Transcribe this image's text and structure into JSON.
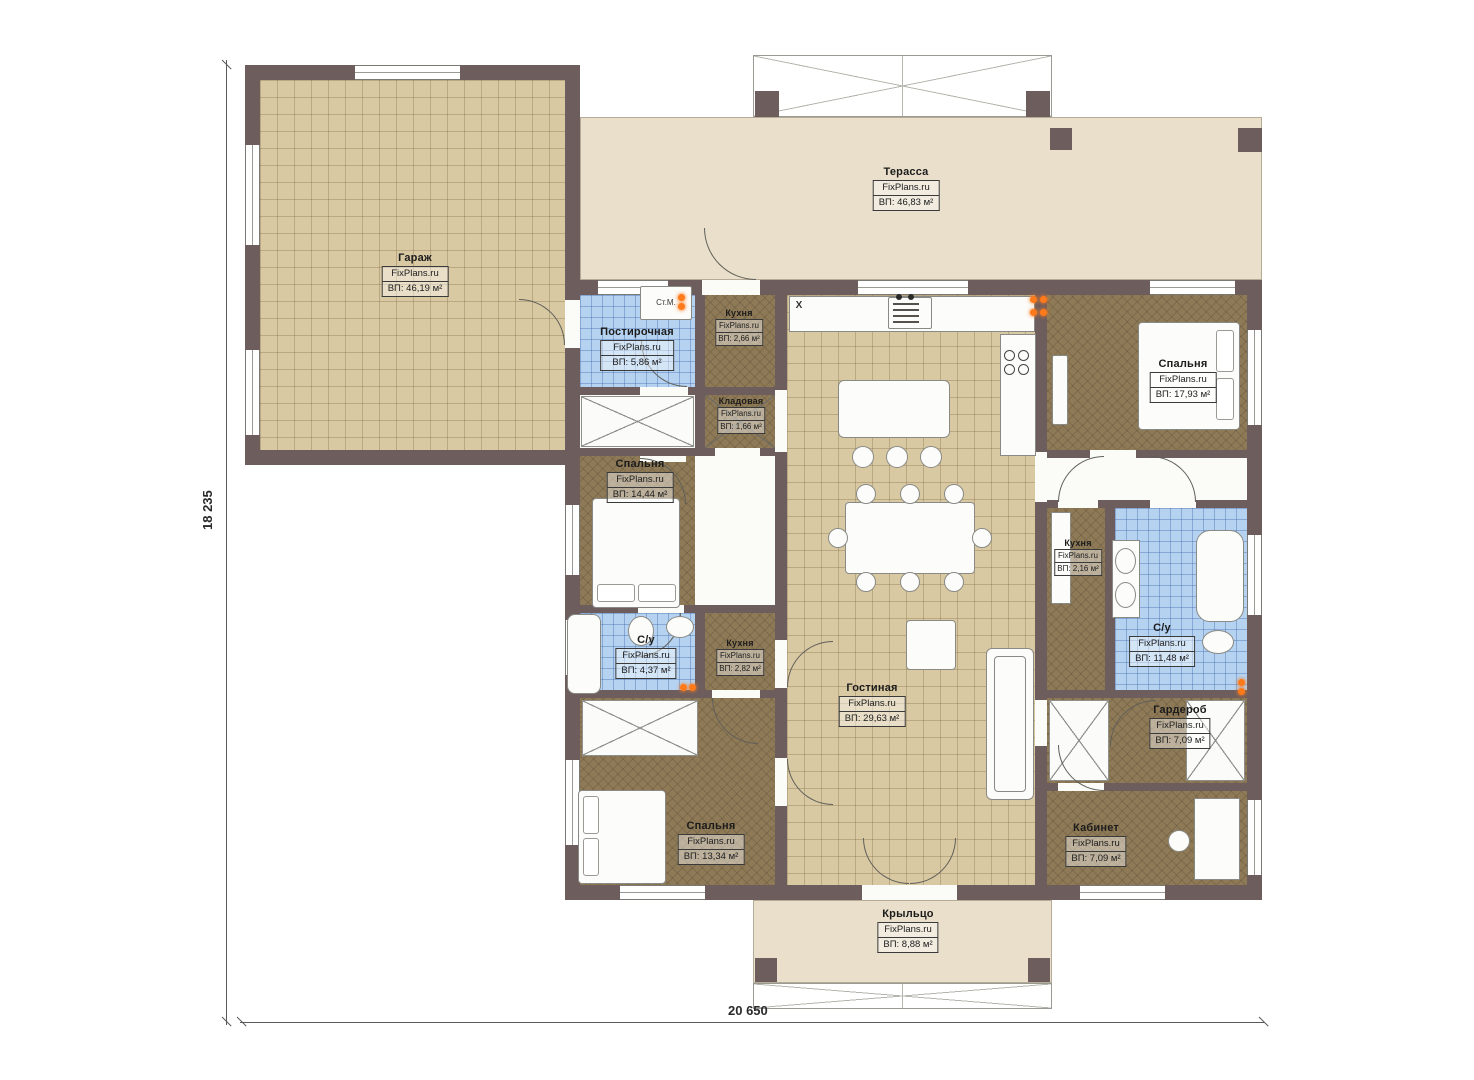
{
  "watermark": "FixPlans.ru",
  "dimensions": {
    "height_label": "18 235",
    "width_label": "20 650"
  },
  "annotations": {
    "washing_machine": "Ст.М.",
    "window_mark": "X"
  },
  "rooms": [
    {
      "id": "garage",
      "name": "Гараж",
      "area": "ВП: 46,19 м²"
    },
    {
      "id": "terrace",
      "name": "Терасса",
      "area": "ВП: 46,83 м²"
    },
    {
      "id": "laundry",
      "name": "Постирочная",
      "area": "ВП: 5,86 м²"
    },
    {
      "id": "kitchen-top",
      "name": "Кухня",
      "area": "ВП: 2,66 м²"
    },
    {
      "id": "pantry",
      "name": "Кладовая",
      "area": "ВП: 1,66 м²"
    },
    {
      "id": "bedroom-left",
      "name": "Спальня",
      "area": "ВП: 14,44 м²"
    },
    {
      "id": "bathroom-left",
      "name": "С/у",
      "area": "ВП: 4,37 м²"
    },
    {
      "id": "kitchen-left",
      "name": "Кухня",
      "area": "ВП: 2,82 м²"
    },
    {
      "id": "living",
      "name": "Гостиная",
      "area": "ВП: 29,63 м²"
    },
    {
      "id": "bedroom-right",
      "name": "Спальня",
      "area": "ВП: 17,93 м²"
    },
    {
      "id": "kitchen-right",
      "name": "Кухня",
      "area": "ВП: 2,16 м²"
    },
    {
      "id": "bathroom-right",
      "name": "С/у",
      "area": "ВП: 11,48 м²"
    },
    {
      "id": "wardrobe",
      "name": "Гардероб",
      "area": "ВП: 7,09 м²"
    },
    {
      "id": "office",
      "name": "Кабинет",
      "area": "ВП: 7,09 м²"
    },
    {
      "id": "bedroom-bottom",
      "name": "Спальня",
      "area": "ВП: 13,34 м²"
    },
    {
      "id": "porch",
      "name": "Крыльцо",
      "area": "ВП: 8,88 м²"
    }
  ],
  "colors": {
    "wall": "#6e5d5d",
    "tile_beige": "#d9c9a3",
    "tile_blue": "#b5d2f0",
    "floor_brown": "#8f7a57",
    "terrace": "#e9dfca",
    "accent_orange": "#ff7a1a"
  }
}
